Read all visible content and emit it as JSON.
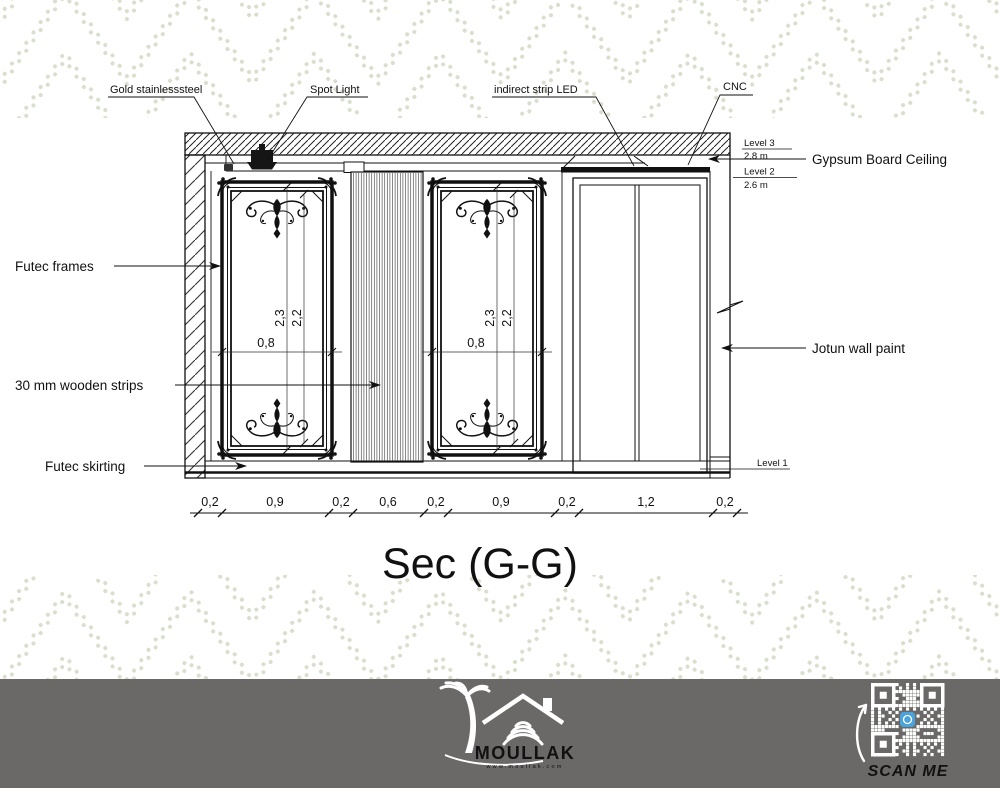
{
  "title": "Sec (G-G)",
  "annotations": {
    "gold_stainless": "Gold stainlesssteel",
    "spot_light": "Spot Light",
    "indirect_led": "indirect strip LED",
    "cnc": "CNC",
    "gypsum_ceiling": "Gypsum Board Ceiling",
    "futec_frames": "Futec frames",
    "wooden_strips": "30 mm wooden strips",
    "futec_skirting": "Futec skirting",
    "jotun_paint": "Jotun wall paint"
  },
  "levels": [
    {
      "name": "Level 3",
      "elevation": "2.8 m"
    },
    {
      "name": "Level 2",
      "elevation": "2.6 m"
    },
    {
      "name": "Level 1",
      "elevation": ""
    }
  ],
  "dimensions": {
    "horizontal": [
      "0,2",
      "0,9",
      "0,2",
      "0,6",
      "0,2",
      "0,9",
      "0,2",
      "1,2",
      "0,2"
    ],
    "frame_height_outer": "2,3",
    "frame_height_inner": "2,2",
    "frame_width": "0,8"
  },
  "footer": {
    "brand": "MOULLAK",
    "website": "www.moullak.com",
    "qr_label": "SCAN ME"
  },
  "colors": {
    "line": "#1a1a1a",
    "chevron": "#d9dfcc",
    "footer_bg": "#6a6968",
    "qr_accent": "#4aa3db"
  }
}
